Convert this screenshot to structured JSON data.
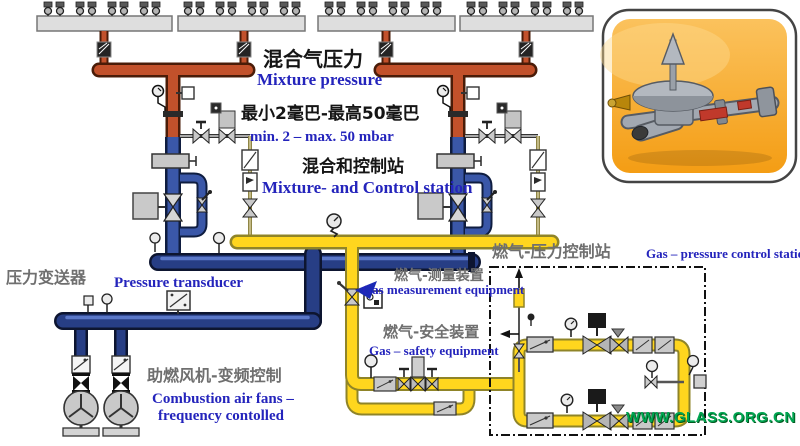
{
  "diagram": {
    "title": "Mixture and gas pressure control station piping diagram",
    "labels": {
      "mixture_pressure_zh": "混合气压力",
      "mixture_pressure_en": "Mixture pressure",
      "pressure_range_zh": "最小2毫巴-最高50毫巴",
      "pressure_range_en": "min. 2 – max. 50 mbar",
      "mixture_control_station_zh": "混合和控制站",
      "mixture_control_station_en": "Mixture- and Control station",
      "gas_pressure_station_zh": "燃气-压力控制站",
      "gas_pressure_station_en": "Gas – pressure control station",
      "pressure_transducer_zh": "压力变送器",
      "pressure_transducer_en": "Pressure transducer",
      "gas_measurement_zh": "燃气-测量装置",
      "gas_measurement_en": "Gas measurement equipment",
      "gas_safety_zh": "燃气-安全装置",
      "gas_safety_en": "Gas –  safety equipment",
      "combustion_fans_zh": "助燃风机-变频控制",
      "combustion_fans_en_line1": "Combustion air fans –",
      "combustion_fans_en_line2": "frequency contolled"
    },
    "watermark": "WWW.GLASS.ORG.CN",
    "colors": {
      "mixture_pipe_red": "#c2512b",
      "air_pipe_blue": "#3a57a8",
      "air_main_navy": "#273e85",
      "gas_pipe_yellow": "#ffd61e",
      "gas_line_khaki": "#8f8545",
      "label_blue": "#2424bc",
      "label_gray": "#6f6f6f",
      "label_black": "#151515",
      "watermark_green": "#00a551",
      "photo_background_orange": "#f6a623"
    },
    "icons": {
      "burner-icon": "circle-on-manifold",
      "flame-arrester-icon": "hatched-block",
      "gauge-icon": "circle-dial",
      "valve-icon": "bowtie",
      "control-valve-icon": "bowtie-with-actuator",
      "filter-icon": "box-with-diagonal",
      "fan-icon": "circle-with-3-blades",
      "vent-arrow-icon": "arrow",
      "pointer-arrow-icon": "solid-blue-arrow"
    },
    "photo": {
      "name": "gas-pressure-regulator-photo",
      "subject": "gas pressure regulator with diaphragm dome and flanged pipe"
    }
  }
}
